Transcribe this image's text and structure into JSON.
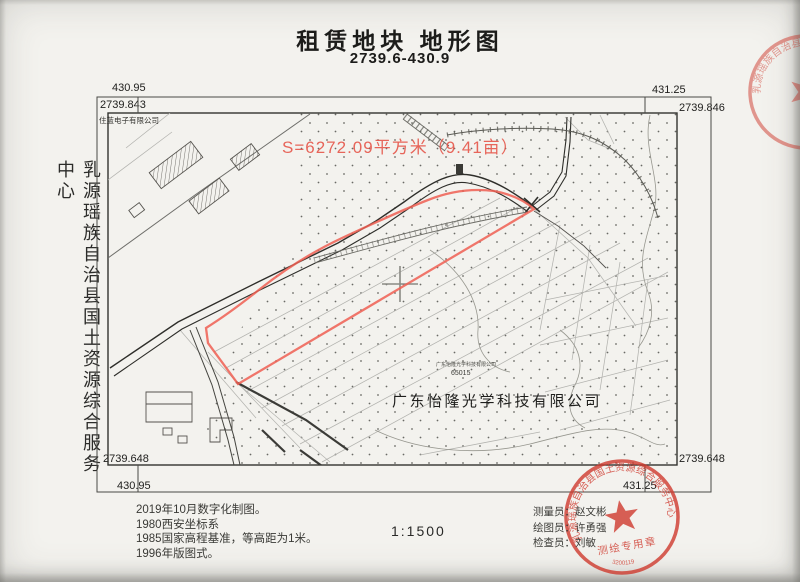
{
  "page": {
    "title": "租赁地块 地形图",
    "subtitle": "2739.6-430.9"
  },
  "side_label": "乳源瑶族自治县国土资源综合服务中心",
  "frame": {
    "x_labels": {
      "top_left": "430.95",
      "top_right": "431.25",
      "bottom_left": "430.95",
      "bottom_right": "431.25"
    },
    "y_labels": {
      "top_left": "2739.843",
      "top_right": "2739.846",
      "bottom_left": "2739.648",
      "bottom_right": "2739.648"
    }
  },
  "map_labels": {
    "area": "S=6272.09平方米（9.41亩）",
    "company_main": "广东怡隆光学科技有限公司",
    "company_small": "广东怡隆光学科技有限公司",
    "parcel_no": "65015",
    "company_corner": "住蓝电子有限公司"
  },
  "legend": {
    "notes": [
      "2019年10月数字化制图。",
      "1980西安坐标系",
      "1985国家高程基准，等高距为1米。",
      "1996年版图式。"
    ],
    "scale": "1:1500",
    "credits": [
      "测量员：赵文彬",
      "绘图员：许勇强",
      "检查员：刘敏"
    ]
  },
  "seal": {
    "ring": "乳源瑶族自治县国土资源综合服务中心",
    "band": "测绘专用章",
    "serial": "3200119"
  },
  "colors": {
    "red_line": "#ef5f52",
    "red_text": "#e6564a",
    "seal_red": "#cf3a2e"
  }
}
